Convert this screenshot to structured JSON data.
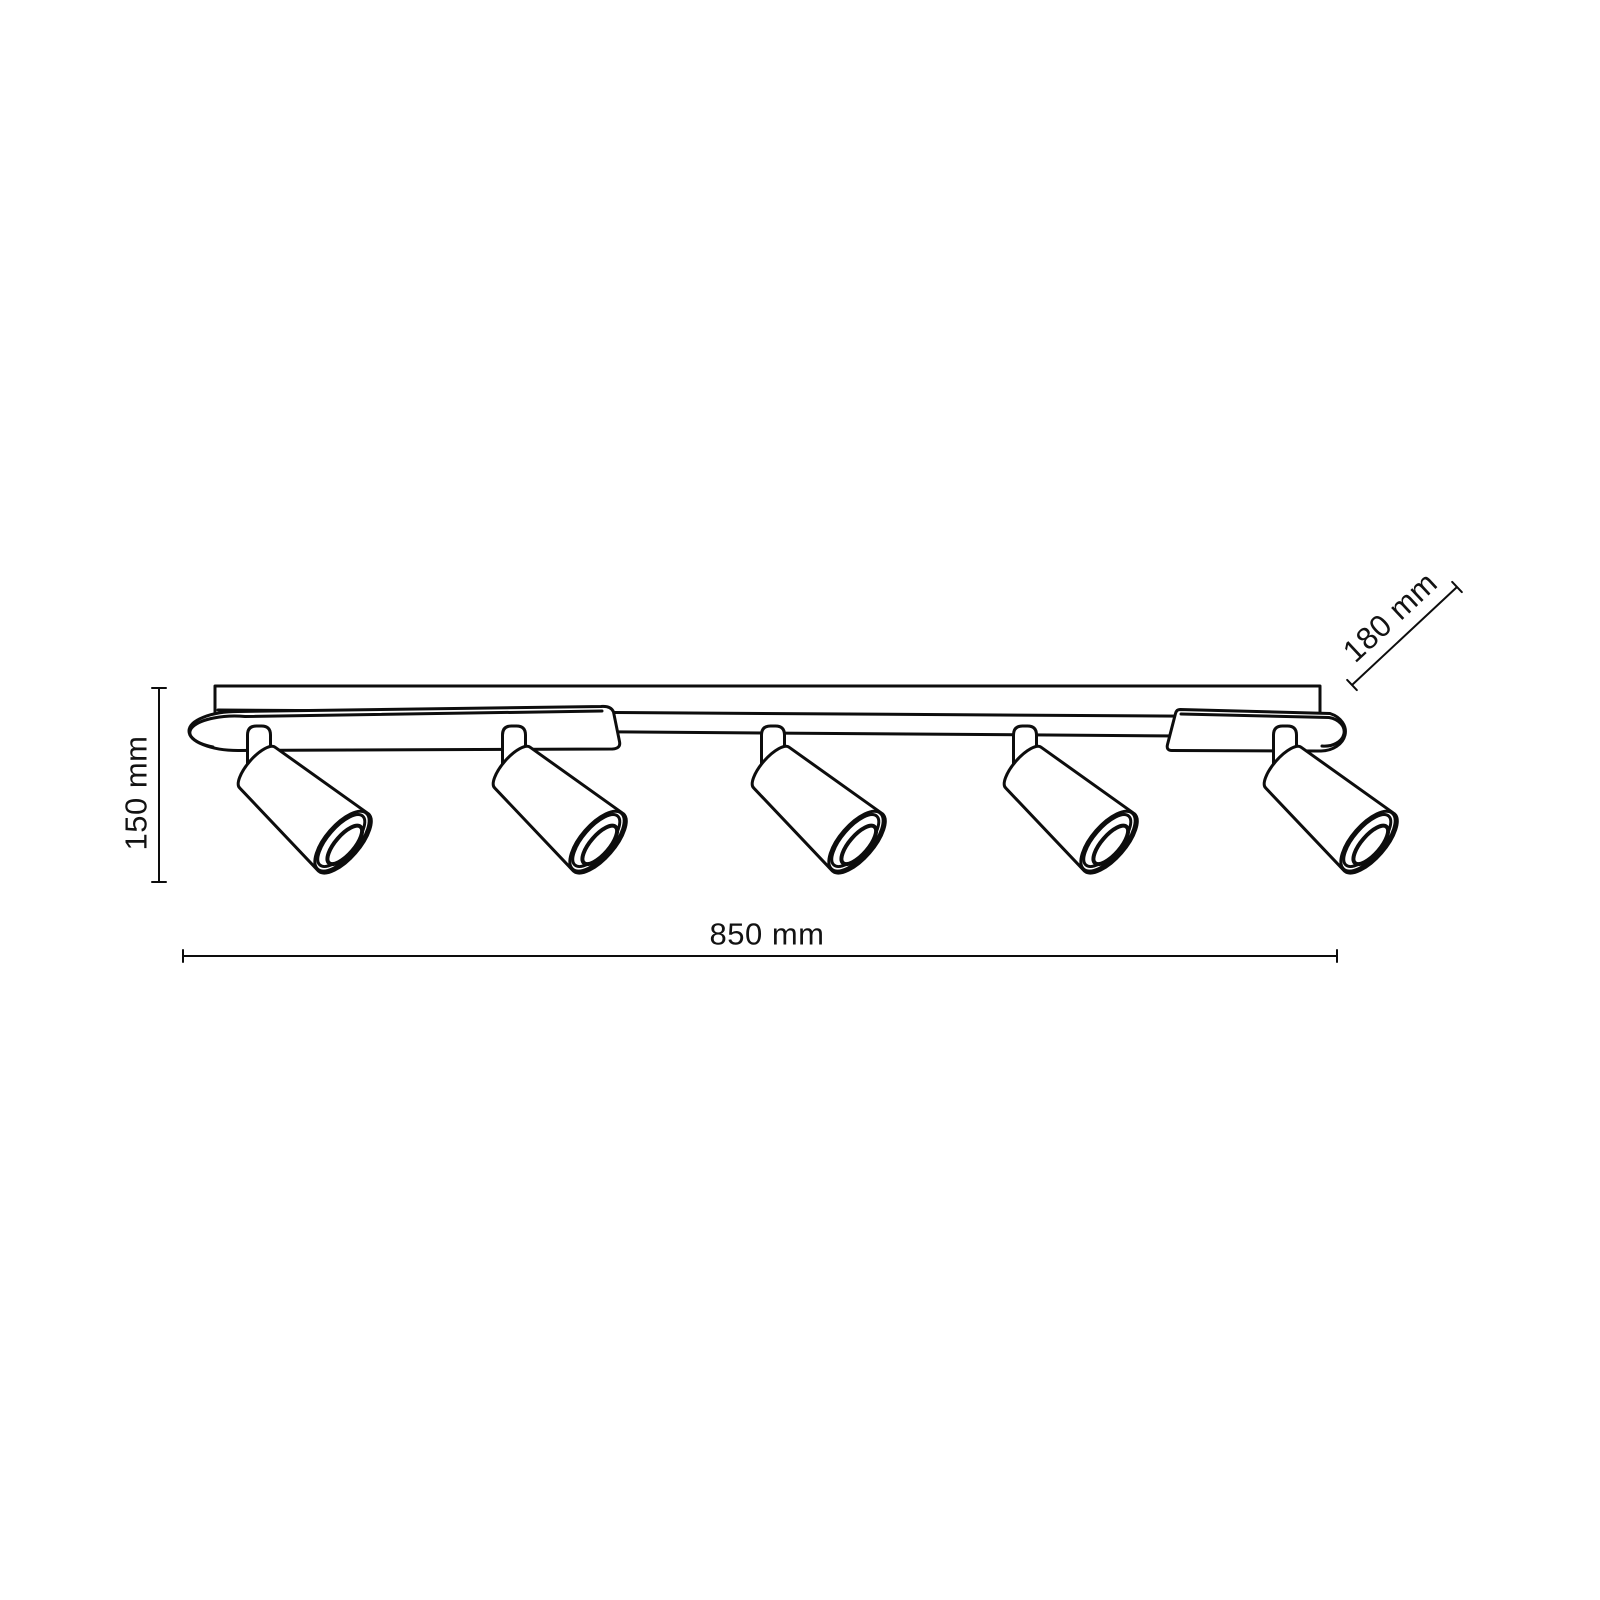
{
  "diagram": {
    "subject": "ceiling-track-spotlight-fixture",
    "style": "technical-dimension-line-drawing",
    "spotlight_count": 5,
    "labels": {
      "width": "850 mm",
      "height": "150 mm",
      "depth": "180 mm"
    },
    "colors": {
      "background": "#ffffff",
      "line": "#0d0d0d",
      "text": "#121212"
    }
  }
}
